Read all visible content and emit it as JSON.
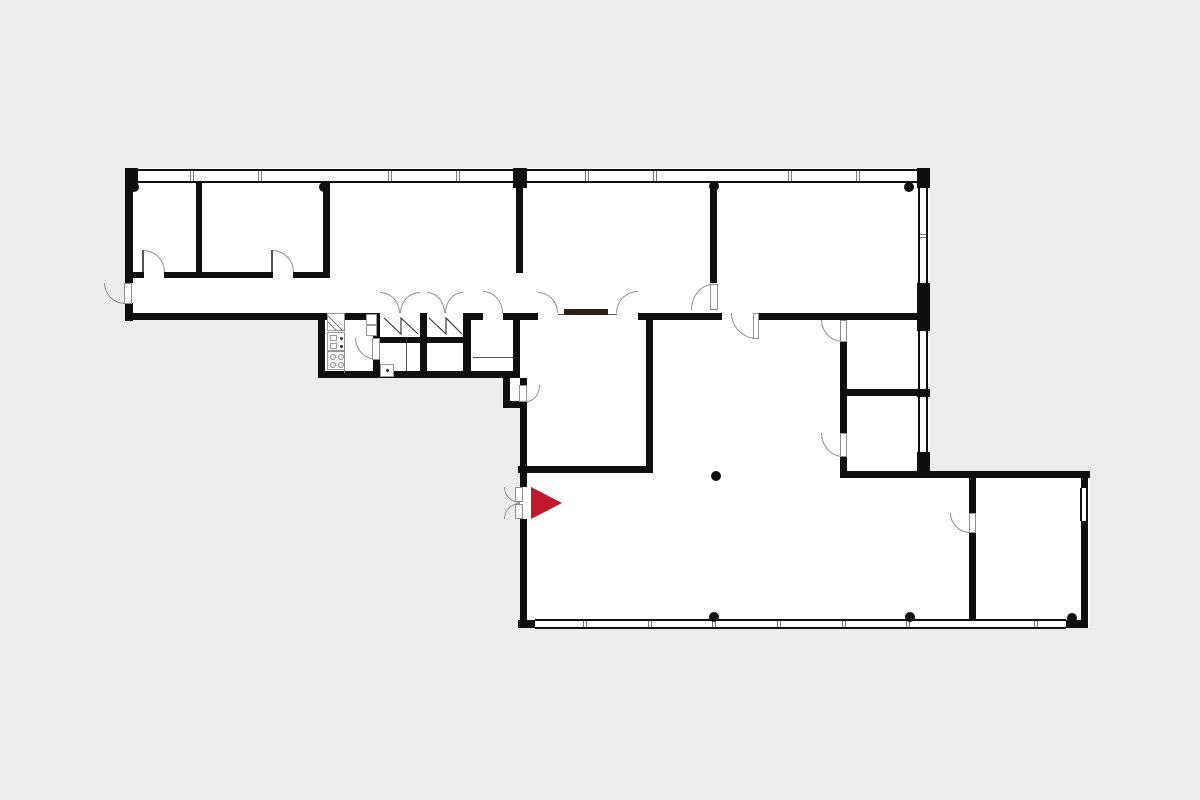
{
  "canvas": {
    "width": 1200,
    "height": 800
  },
  "colors": {
    "background": "#ececec",
    "floor": "#ffffff",
    "wall": "#0f0f0f",
    "arc_stroke": "#8f8f8f",
    "detail": "#555555",
    "symbol_stroke": "#3a3a3a",
    "shaft_stroke": "#777777",
    "sliding_panel": "#2b211c",
    "accent_red": "#c2182c"
  },
  "entrance_marker": {
    "points": "531,487 562,503 531,519"
  },
  "floors": [
    {
      "x": 125,
      "y": 168,
      "w": 805,
      "h": 152
    },
    {
      "x": 318,
      "y": 313,
      "w": 202,
      "h": 65
    },
    {
      "x": 513,
      "y": 313,
      "w": 417,
      "h": 94
    },
    {
      "x": 520,
      "y": 407,
      "w": 410,
      "h": 64
    },
    {
      "x": 503,
      "y": 378,
      "w": 26,
      "h": 30
    },
    {
      "x": 520,
      "y": 471,
      "w": 570,
      "h": 157
    }
  ],
  "walls": [
    {
      "x": 125,
      "y": 168,
      "w": 8,
      "h": 115
    },
    {
      "x": 125,
      "y": 303,
      "w": 8,
      "h": 18
    },
    {
      "x": 125,
      "y": 168,
      "w": 13,
      "h": 20
    },
    {
      "x": 196,
      "y": 183,
      "w": 6,
      "h": 90
    },
    {
      "x": 323,
      "y": 183,
      "w": 7,
      "h": 95
    },
    {
      "x": 125,
      "y": 272,
      "w": 19,
      "h": 6
    },
    {
      "x": 164,
      "y": 272,
      "w": 109,
      "h": 6
    },
    {
      "x": 293,
      "y": 272,
      "w": 37,
      "h": 6
    },
    {
      "x": 125,
      "y": 313,
      "w": 200,
      "h": 7
    },
    {
      "x": 513,
      "y": 168,
      "w": 14,
      "h": 20
    },
    {
      "x": 516,
      "y": 186,
      "w": 7,
      "h": 87
    },
    {
      "x": 710,
      "y": 183,
      "w": 7,
      "h": 100
    },
    {
      "x": 917,
      "y": 168,
      "w": 13,
      "h": 20
    },
    {
      "x": 917,
      "y": 283,
      "w": 13,
      "h": 48
    },
    {
      "x": 917,
      "y": 389,
      "w": 13,
      "h": 8
    },
    {
      "x": 917,
      "y": 452,
      "w": 13,
      "h": 26
    },
    {
      "x": 318,
      "y": 313,
      "w": 7,
      "h": 65
    },
    {
      "x": 318,
      "y": 371,
      "w": 196,
      "h": 7
    },
    {
      "x": 373,
      "y": 313,
      "w": 7,
      "h": 26
    },
    {
      "x": 373,
      "y": 359,
      "w": 7,
      "h": 19
    },
    {
      "x": 420,
      "y": 313,
      "w": 7,
      "h": 65
    },
    {
      "x": 463,
      "y": 313,
      "w": 8,
      "h": 65
    },
    {
      "x": 513,
      "y": 313,
      "w": 7,
      "h": 65
    },
    {
      "x": 380,
      "y": 337,
      "w": 40,
      "h": 6
    },
    {
      "x": 427,
      "y": 337,
      "w": 37,
      "h": 6
    },
    {
      "x": 503,
      "y": 378,
      "w": 7,
      "h": 26
    },
    {
      "x": 503,
      "y": 401,
      "w": 24,
      "h": 7
    },
    {
      "x": 520,
      "y": 378,
      "w": 7,
      "h": 8
    },
    {
      "x": 325,
      "y": 313,
      "w": 55,
      "h": 7
    },
    {
      "x": 463,
      "y": 313,
      "w": 20,
      "h": 7
    },
    {
      "x": 503,
      "y": 313,
      "w": 35,
      "h": 7
    },
    {
      "x": 638,
      "y": 313,
      "w": 84,
      "h": 7
    },
    {
      "x": 757,
      "y": 313,
      "w": 173,
      "h": 7
    },
    {
      "x": 646,
      "y": 313,
      "w": 7,
      "h": 160
    },
    {
      "x": 518,
      "y": 466,
      "w": 135,
      "h": 7
    },
    {
      "x": 520,
      "y": 401,
      "w": 7,
      "h": 86
    },
    {
      "x": 520,
      "y": 519,
      "w": 7,
      "h": 109
    },
    {
      "x": 518,
      "y": 620,
      "w": 17,
      "h": 8
    },
    {
      "x": 840,
      "y": 342,
      "w": 7,
      "h": 91
    },
    {
      "x": 840,
      "y": 457,
      "w": 7,
      "h": 14
    },
    {
      "x": 847,
      "y": 389,
      "w": 70,
      "h": 7
    },
    {
      "x": 840,
      "y": 471,
      "w": 250,
      "h": 7
    },
    {
      "x": 1081,
      "y": 478,
      "w": 7,
      "h": 10
    },
    {
      "x": 1081,
      "y": 521,
      "w": 7,
      "h": 107
    },
    {
      "x": 1066,
      "y": 620,
      "w": 22,
      "h": 8
    },
    {
      "x": 969,
      "y": 478,
      "w": 7,
      "h": 35
    },
    {
      "x": 969,
      "y": 533,
      "w": 7,
      "h": 95
    }
  ],
  "windows": [
    {
      "dir": "h",
      "x": 138,
      "y": 169,
      "w": 375,
      "h": 14,
      "mull": [
        192,
        260,
        390,
        458
      ]
    },
    {
      "dir": "h",
      "x": 527,
      "y": 169,
      "w": 390,
      "h": 14,
      "mull": [
        587,
        655,
        790,
        858
      ]
    },
    {
      "dir": "h",
      "x": 535,
      "y": 619,
      "w": 531,
      "h": 10,
      "mull": [
        585,
        650,
        714,
        779,
        844,
        908,
        1036
      ]
    },
    {
      "dir": "v",
      "x": 918,
      "y": 188,
      "w": 10,
      "h": 95,
      "mull": [
        236
      ]
    },
    {
      "dir": "v",
      "x": 918,
      "y": 331,
      "w": 10,
      "h": 58,
      "mull": []
    },
    {
      "dir": "v",
      "x": 918,
      "y": 397,
      "w": 10,
      "h": 55,
      "mull": []
    },
    {
      "dir": "v",
      "x": 1080,
      "y": 488,
      "w": 8,
      "h": 33,
      "mull": []
    }
  ],
  "door_arcs": [
    {
      "x": 143,
      "y": 250,
      "w": 22,
      "h": 22,
      "corner": "tr"
    },
    {
      "x": 272,
      "y": 250,
      "w": 22,
      "h": 22,
      "corner": "tr"
    },
    {
      "x": 104,
      "y": 283,
      "w": 21,
      "h": 21,
      "corner": "bl"
    },
    {
      "x": 380,
      "y": 292,
      "w": 20,
      "h": 21,
      "corner": "tr"
    },
    {
      "x": 400,
      "y": 292,
      "w": 20,
      "h": 21,
      "corner": "tl"
    },
    {
      "x": 427,
      "y": 292,
      "w": 18,
      "h": 21,
      "corner": "tr"
    },
    {
      "x": 445,
      "y": 292,
      "w": 18,
      "h": 21,
      "corner": "tl"
    },
    {
      "x": 483,
      "y": 291,
      "w": 20,
      "h": 22,
      "corner": "tr"
    },
    {
      "x": 538,
      "y": 292,
      "w": 20,
      "h": 21,
      "corner": "tr"
    },
    {
      "x": 616,
      "y": 291,
      "w": 22,
      "h": 22,
      "corner": "tl"
    },
    {
      "x": 691,
      "y": 284,
      "w": 22,
      "h": 26,
      "corner": "tl"
    },
    {
      "x": 731,
      "y": 313,
      "w": 26,
      "h": 26,
      "corner": "bl"
    },
    {
      "x": 355,
      "y": 338,
      "w": 22,
      "h": 22,
      "corner": "bl"
    },
    {
      "x": 504,
      "y": 487,
      "w": 16,
      "h": 16,
      "corner": "bl"
    },
    {
      "x": 504,
      "y": 503,
      "w": 16,
      "h": 16,
      "corner": "tl"
    },
    {
      "x": 821,
      "y": 320,
      "w": 22,
      "h": 22,
      "corner": "bl"
    },
    {
      "x": 821,
      "y": 433,
      "w": 22,
      "h": 24,
      "corner": "bl"
    },
    {
      "x": 950,
      "y": 513,
      "w": 20,
      "h": 20,
      "corner": "bl"
    },
    {
      "x": 527,
      "y": 385,
      "w": 13,
      "h": 17,
      "corner": "br"
    }
  ],
  "door_leaves": [
    {
      "x": 124,
      "y": 283,
      "w": 8,
      "h": 21
    },
    {
      "x": 710,
      "y": 284,
      "w": 8,
      "h": 26
    },
    {
      "x": 753,
      "y": 313,
      "w": 6,
      "h": 26
    },
    {
      "x": 372,
      "y": 338,
      "w": 8,
      "h": 22
    },
    {
      "x": 515,
      "y": 487,
      "w": 8,
      "h": 15
    },
    {
      "x": 515,
      "y": 504,
      "w": 8,
      "h": 15
    },
    {
      "x": 840,
      "y": 320,
      "w": 7,
      "h": 22
    },
    {
      "x": 840,
      "y": 433,
      "w": 7,
      "h": 24
    },
    {
      "x": 969,
      "y": 513,
      "w": 7,
      "h": 20
    },
    {
      "x": 519,
      "y": 385,
      "w": 8,
      "h": 17
    }
  ],
  "detail_lines": [
    {
      "name": "sliding-door-track",
      "x": 558,
      "y": 314,
      "w": 59,
      "h": 1
    },
    {
      "name": "counter-line",
      "x": 473,
      "y": 357,
      "w": 40,
      "h": 1
    },
    {
      "name": "partition-line",
      "x": 406,
      "y": 343,
      "w": 1,
      "h": 28
    },
    {
      "name": "door-leaf-line",
      "x": 142,
      "y": 250,
      "w": 2,
      "h": 22
    },
    {
      "name": "door-leaf-line",
      "x": 271,
      "y": 250,
      "w": 2,
      "h": 22
    }
  ],
  "sliding_panels": [
    {
      "x": 564,
      "y": 309,
      "w": 44,
      "h": 6
    }
  ],
  "columns": [
    {
      "x": 134,
      "y": 187
    },
    {
      "x": 324,
      "y": 187
    },
    {
      "x": 714,
      "y": 186
    },
    {
      "x": 909,
      "y": 187
    },
    {
      "x": 716,
      "y": 476
    },
    {
      "x": 714,
      "y": 617
    },
    {
      "x": 910,
      "y": 617
    },
    {
      "x": 1072,
      "y": 618
    }
  ],
  "fixtures": [
    {
      "name": "shaft-symbol",
      "style": "outline",
      "x": 327,
      "y": 313,
      "w": 18,
      "h": 18
    },
    {
      "name": "kitchen-sink",
      "style": "outline",
      "x": 327,
      "y": 332,
      "w": 18,
      "h": 19
    },
    {
      "name": "sink-basin",
      "style": "outline",
      "x": 330,
      "y": 335,
      "w": 7,
      "h": 6
    },
    {
      "name": "sink-basin",
      "style": "outline",
      "x": 330,
      "y": 343,
      "w": 7,
      "h": 6
    },
    {
      "name": "sink-dot",
      "style": "dot",
      "x": 340,
      "y": 337
    },
    {
      "name": "sink-dot",
      "style": "dot",
      "x": 340,
      "y": 345
    },
    {
      "name": "stove",
      "style": "outline",
      "x": 327,
      "y": 351,
      "w": 18,
      "h": 19
    },
    {
      "name": "stove-burner",
      "style": "circle",
      "x": 330,
      "y": 354,
      "w": 6,
      "h": 6
    },
    {
      "name": "stove-burner",
      "style": "circle",
      "x": 338,
      "y": 354,
      "w": 6,
      "h": 6
    },
    {
      "name": "stove-burner",
      "style": "circle",
      "x": 330,
      "y": 362,
      "w": 6,
      "h": 6
    },
    {
      "name": "stove-burner",
      "style": "circle",
      "x": 338,
      "y": 362,
      "w": 6,
      "h": 6
    },
    {
      "name": "counter-edge",
      "style": "dashed",
      "x": 344,
      "y": 313,
      "w": 2,
      "h": 60
    },
    {
      "name": "cabinet",
      "style": "outline",
      "x": 366,
      "y": 314,
      "w": 11,
      "h": 11
    },
    {
      "name": "cabinet",
      "style": "outline",
      "x": 366,
      "y": 325,
      "w": 11,
      "h": 11
    },
    {
      "name": "wc-fixture",
      "style": "outline",
      "x": 380,
      "y": 364,
      "w": 14,
      "h": 13
    },
    {
      "name": "wc-dot",
      "style": "dot",
      "x": 386,
      "y": 369
    }
  ],
  "zigzags": [
    {
      "points": "384,318 401,334 401,318 418,334"
    },
    {
      "points": "429,318 446,334 446,318 462,334"
    }
  ],
  "shaft_lines": [
    {
      "x1": 328,
      "y1": 316,
      "x2": 342,
      "y2": 330
    },
    {
      "x1": 328,
      "y1": 322,
      "x2": 336,
      "y2": 330
    }
  ]
}
